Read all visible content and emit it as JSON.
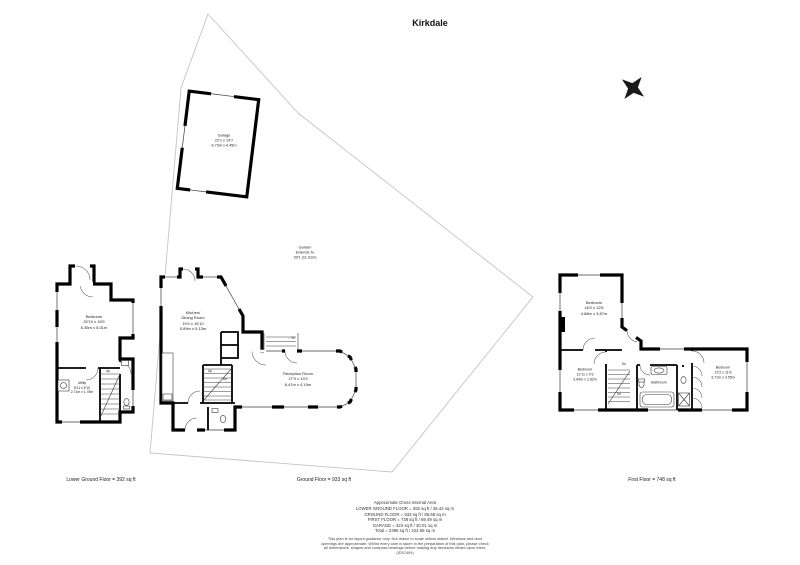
{
  "title": "Kirkdale",
  "icons": {
    "entrance_arrow": "←",
    "compass": "four-point-star"
  },
  "garage": {
    "name": "Garage",
    "imperial": "22'1 x 14'7",
    "metric": "6.73m x 4.45m"
  },
  "garden": {
    "name": "Garden",
    "line2": "Extends To",
    "line3": "39'1 (11.91m)"
  },
  "lower_ground": {
    "footer": "Lower Ground Floor = 392 sq ft",
    "bedroom": {
      "name": "Bedroom",
      "imperial": "20'10 x 16'5",
      "metric": "6.35m x 5.01m"
    },
    "utility": {
      "name": "Utility",
      "imperial": "8'11 x 5'10",
      "metric": "2.71m x 1.78m"
    },
    "up": "Up"
  },
  "ground": {
    "footer": "Ground Floor = 933 sq ft",
    "kitchen": {
      "name1": "Kitchen/",
      "name2": "Dining Room",
      "imperial": "19'4 x 16'10",
      "metric": "5.89m x 5.13m"
    },
    "reception": {
      "name": "Reception Room",
      "imperial": "27'9 x 13'9",
      "metric": "8.47m x 4.19m"
    },
    "entrance": "IN",
    "up": "Up",
    "dn": "Dn"
  },
  "first": {
    "footer": "First Floor = 748 sq ft",
    "bedroom1": {
      "name": "Bedroom",
      "imperial": "16'0 x 12'8",
      "metric": "4.88m x 3.87m"
    },
    "bedroom2": {
      "name": "Bedroom",
      "imperial": "12'11 x 9'3",
      "metric": "3.94m x 2.82m"
    },
    "bedroom3": {
      "name": "Bedroom",
      "imperial": "12'2 x 11'8",
      "metric": "3.71m x 3.55m"
    },
    "bathroom": "Bathroom",
    "dn": "Dn"
  },
  "summary": {
    "heading": "Approximate Gross Internal Area",
    "lines": [
      "LOWER GROUND FLOOR = 392 sq ft / 36.42 sq m",
      "GROUND FLOOR = 933 sq ft / 86.68 sq m",
      "FIRST FLOOR = 748 sq ft / 69.49 sq m",
      "GARAGE = 323 sq ft / 30.01 sq m",
      "Total = 2396 sq ft / 222.59 sq m"
    ]
  },
  "disclaimer": "This plan is for layout guidance only. Not drawn to scale unless stated. Windows and door openings are approximate. Whilst every care is taken in the preparation of this plan, please check all dimensions, shapes and compass bearings before making any decisions reliant upon them. (ID37409)"
}
